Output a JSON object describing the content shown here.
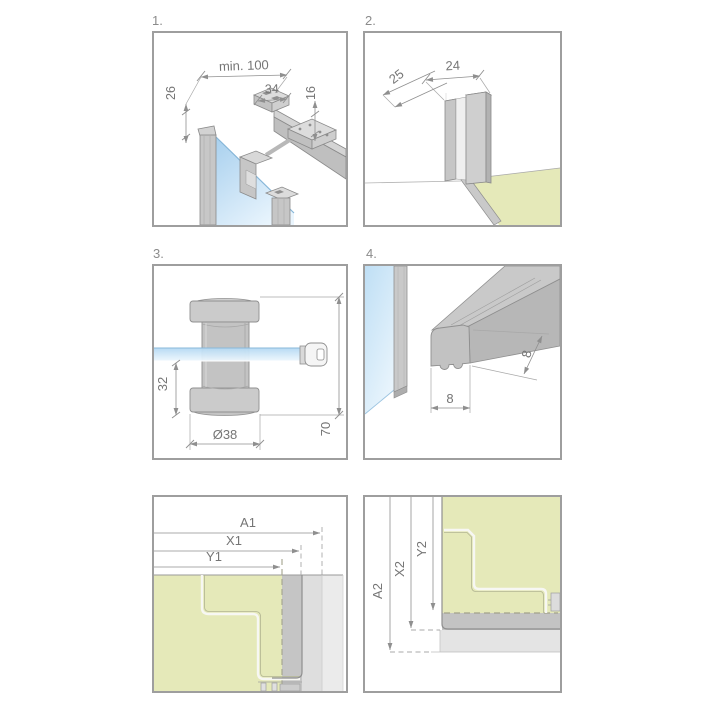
{
  "figure": {
    "kind": "technical installation diagram, 6 numbered detail panels"
  },
  "colors": {
    "panel_border": "#9e9e9e",
    "line_gray": "#8f8f8f",
    "dim_text": "#757575",
    "metal_light": "#dcdcdc",
    "metal_mid": "#c9c9c9",
    "metal_dark": "#b4b4b4",
    "glass_blue": "#aed4f0",
    "glass_blue_light": "#eaf5fd",
    "floor_green": "#e5e9b9",
    "band_dark": "#c5c5c5",
    "band_mid": "#dedede",
    "band_light": "#ebebeb"
  },
  "panels": {
    "p1": {
      "label": "1.",
      "dims": {
        "min_width": "min. 100",
        "bracket_width": "34",
        "bar_height": "16",
        "offset": "26"
      }
    },
    "p2": {
      "label": "2.",
      "dims": {
        "depth": "25",
        "width": "24"
      }
    },
    "p3": {
      "label": "3.",
      "dims": {
        "glass_offset": "32",
        "diameter": "Ø38",
        "height": "70"
      }
    },
    "p4": {
      "label": "4.",
      "dims": {
        "height": "8",
        "width": "8"
      }
    },
    "p5": {
      "dims": {
        "a": "A1",
        "x": "X1",
        "y": "Y1"
      }
    },
    "p6": {
      "dims": {
        "a": "A2",
        "x": "X2",
        "y": "Y2"
      }
    }
  }
}
